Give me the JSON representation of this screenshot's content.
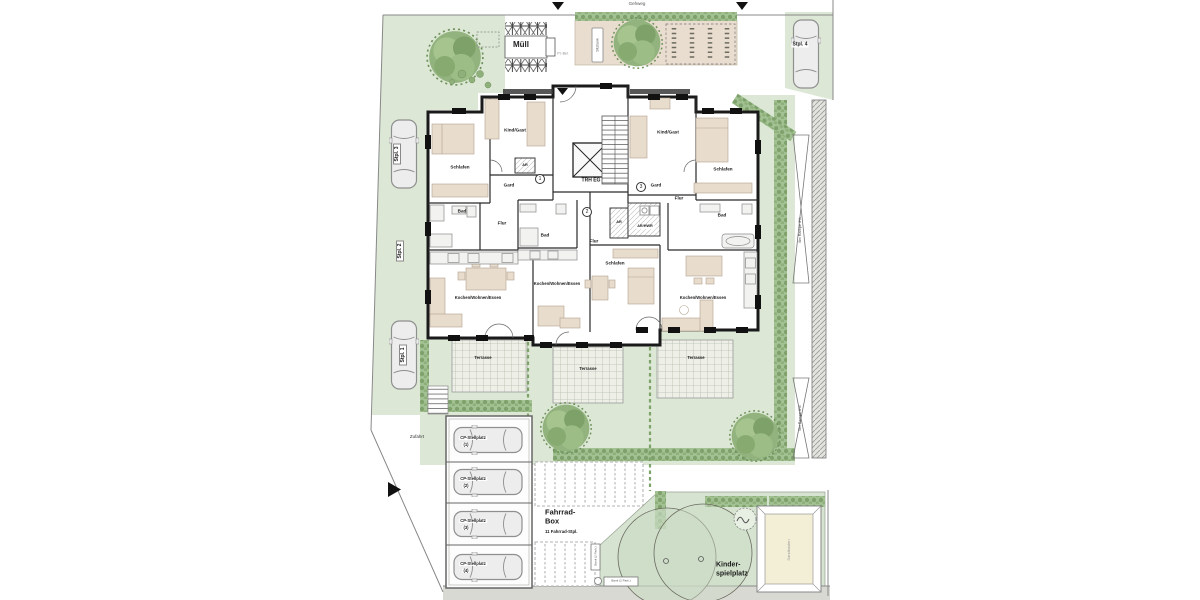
{
  "colors": {
    "lawn": "#dce8d5",
    "hedge": "#a2c293",
    "planting_bed": "#e9ddcf",
    "terrace": "#eef0e8",
    "wall": "#1a1a1a",
    "furniture": "#e8dccc",
    "sand": "#f3eed6",
    "pavement": "#d9d9d3"
  },
  "site": {
    "gehweg": "Gehweg",
    "muell": "Müll",
    "zufahrt": "Zufahrt",
    "path_label": "Pl.-Bel.",
    "bench_top": "Sitzbank",
    "ramp_upper": "6m Rampe 3%",
    "ramp_lower": "6m Rampe 6%"
  },
  "parking": {
    "stpl": [
      "Stpl. 1",
      "Stpl. 2",
      "Stpl. 3",
      "Stpl. 4"
    ],
    "carport_label": "CP-Stellplatz",
    "carport_numbers": [
      "(1)",
      "(2)",
      "(3)",
      "(4)"
    ]
  },
  "bike": {
    "title_line1": "Fahrrad-",
    "title_line2": "Box",
    "subtitle": "11 Fahrrad-Stpl."
  },
  "playground": {
    "title_line1": "Kinder-",
    "title_line2": "spielplatz",
    "sandbox": "Sandkasten",
    "bench": "Bank (2 Park.)"
  },
  "building": {
    "staircase": "TRH EG",
    "units": [
      "1",
      "2",
      "3"
    ],
    "rooms": {
      "schlafen": "Schlafen",
      "bad": "Bad",
      "flur": "Flur",
      "kind_gast": "Kind/Gast",
      "gard": "Gard",
      "ar": "AR",
      "ar_hwr": "AR/HWR",
      "kochen_wohnen_essen": "Kochen/Wohnen/Essen",
      "terrasse": "Terrasse"
    }
  }
}
